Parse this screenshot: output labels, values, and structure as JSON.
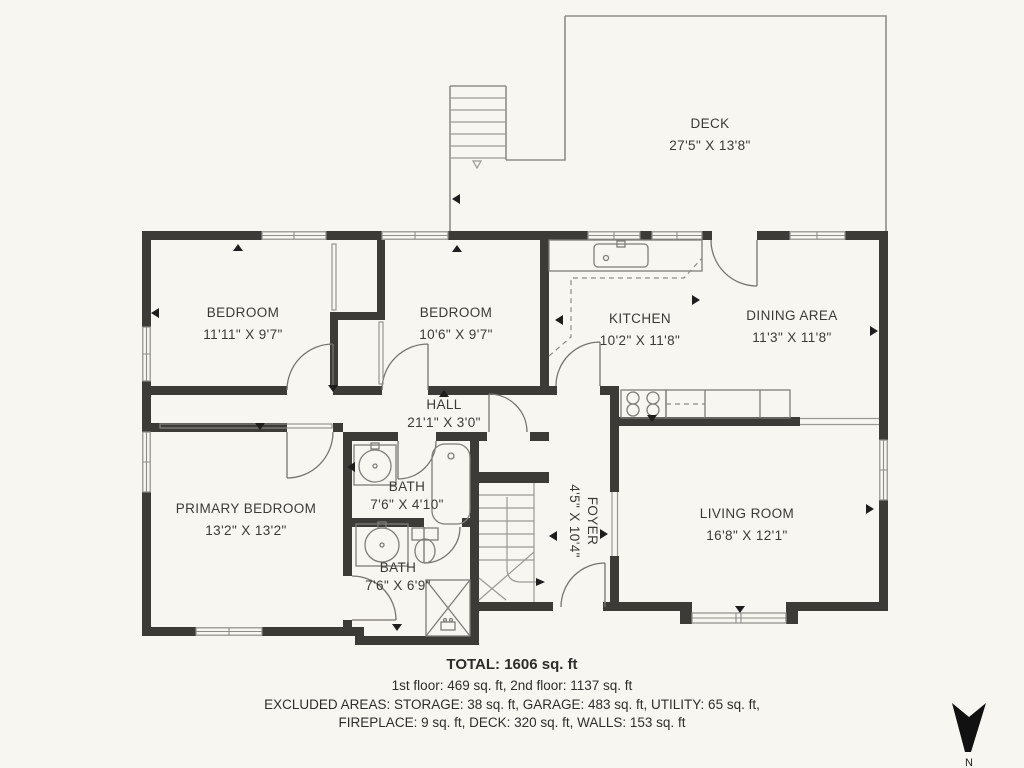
{
  "rooms": {
    "deck": {
      "name": "DECK",
      "dims": "27'5\" X 13'8\""
    },
    "bedroom1": {
      "name": "BEDROOM",
      "dims": "11'11\" X 9'7\""
    },
    "bedroom2": {
      "name": "BEDROOM",
      "dims": "10'6\" X 9'7\""
    },
    "kitchen": {
      "name": "KITCHEN",
      "dims": "10'2\" X 11'8\""
    },
    "dining": {
      "name": "DINING AREA",
      "dims": "11'3\" X 11'8\""
    },
    "hall": {
      "name": "HALL",
      "dims": "21'1\" X 3'0\""
    },
    "bath1": {
      "name": "BATH",
      "dims": "7'6\" X 4'10\""
    },
    "foyer": {
      "name": "FOYER",
      "dims": "4'5\" X 10'4\""
    },
    "primary_bedroom": {
      "name": "PRIMARY BEDROOM",
      "dims": "13'2\" X 13'2\""
    },
    "bath2": {
      "name": "BATH",
      "dims": "7'6\" X 6'9\""
    },
    "living": {
      "name": "LIVING ROOM",
      "dims": "16'8\" X 12'1\""
    }
  },
  "summary": {
    "total": "TOTAL: 1606 sq. ft",
    "floors": "1st floor: 469 sq. ft, 2nd floor: 1137 sq. ft",
    "excluded_1": "EXCLUDED AREAS: STORAGE: 38 sq. ft, GARAGE: 483 sq. ft, UTILITY: 65 sq. ft,",
    "excluded_2": "FIREPLACE: 9 sq. ft, DECK: 320 sq. ft, WALLS: 153 sq. ft"
  },
  "compass": {
    "label": "N"
  },
  "colors": {
    "background": "#f7f6f1",
    "wall": "#3d3b38",
    "thin_line": "#8f8d88",
    "text": "#3c3a37",
    "compass": "#1e1e1e"
  }
}
